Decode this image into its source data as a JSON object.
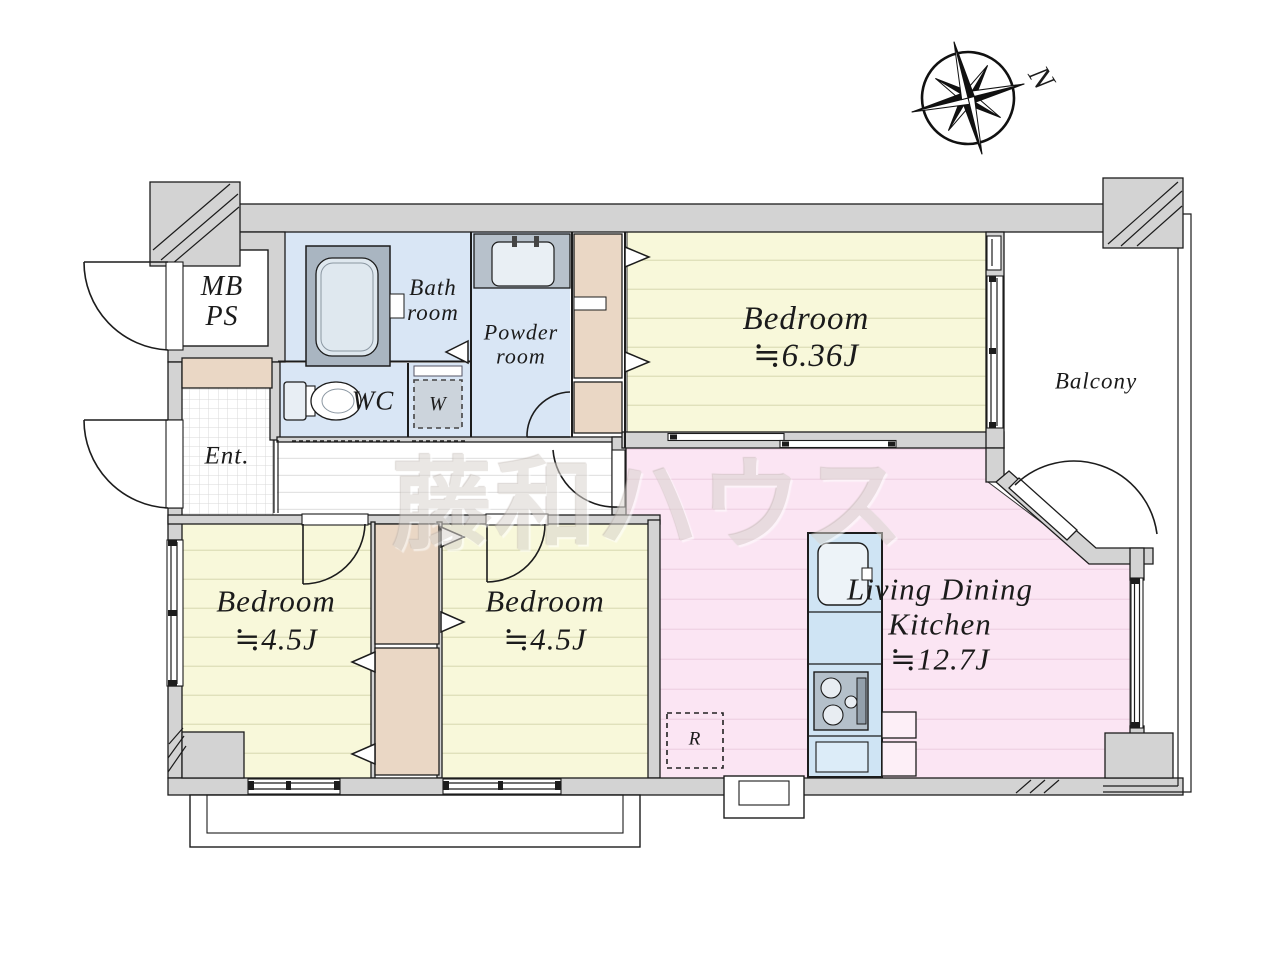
{
  "watermark": {
    "text": "藤和ハウス"
  },
  "compass": {
    "label": "N"
  },
  "rooms": {
    "meter_box": {
      "line1": "MB",
      "line2": "PS"
    },
    "bathroom": {
      "line1": "Bath",
      "line2": "room"
    },
    "powder_room": {
      "line1": "Powder",
      "line2": "room"
    },
    "wc": {
      "name": "WC"
    },
    "washer": {
      "label": "W"
    },
    "entrance": {
      "name": "Ent."
    },
    "bedroom_main": {
      "name": "Bedroom",
      "size": "≒6.36J"
    },
    "bedroom_west": {
      "name": "Bedroom",
      "size": "≒4.5J"
    },
    "bedroom_center": {
      "name": "Bedroom",
      "size": "≒4.5J"
    },
    "ldk": {
      "line1": "Living Dining",
      "line2": "Kitchen",
      "size": "≒12.7J"
    },
    "balcony": {
      "name": "Balcony"
    },
    "refrigerator": {
      "label": "R"
    }
  },
  "colors": {
    "wall_fill": "#d3d3d3",
    "wall_stroke": "#1c1c1c",
    "bedroom_fill": "#f8f8da",
    "bedroom_line": "#e0e1bb",
    "ldk_fill": "#fbe5f3",
    "ldk_line": "#f0d3e5",
    "wet_area_fill": "#d9e6f5",
    "closet_fill": "#ead7c5",
    "bathtub_fill": "#a9b5c1",
    "kitchen_counter_fill": "#cfe4f4",
    "watermark_color": "#d9d4cf"
  }
}
